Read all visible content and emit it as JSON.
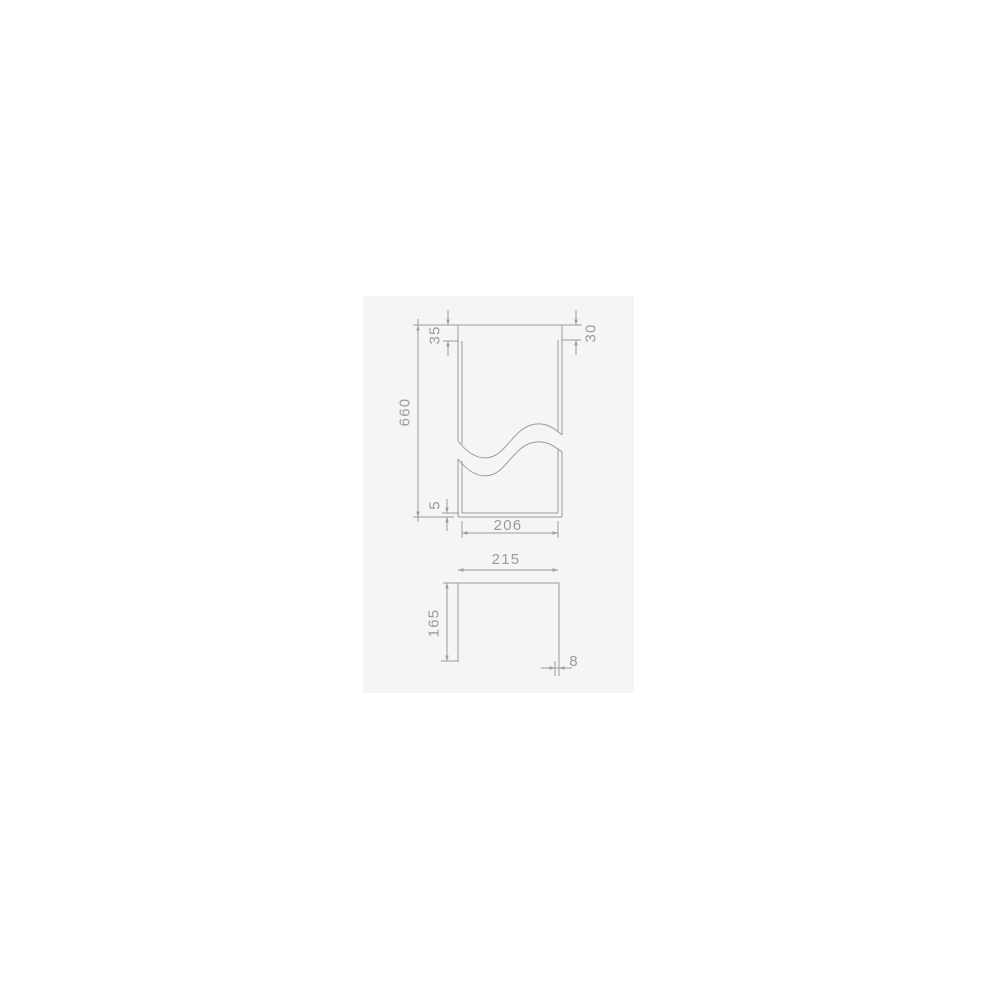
{
  "page": {
    "background_color": "#ffffff"
  },
  "canvas": {
    "background_color": "#f5f5f6",
    "stroke_color": "#9b9b9f",
    "text_color": "#9b9b9f"
  },
  "drawing": {
    "type": "technical-dimension-drawing",
    "front_view": {
      "dims": {
        "inset_left": "35",
        "inset_right": "30",
        "overall_height": "660",
        "base_gap": "5",
        "inner_width": "206"
      }
    },
    "plan_view": {
      "dims": {
        "overall_width": "215",
        "depth": "165",
        "wall_thickness": "8"
      }
    }
  }
}
